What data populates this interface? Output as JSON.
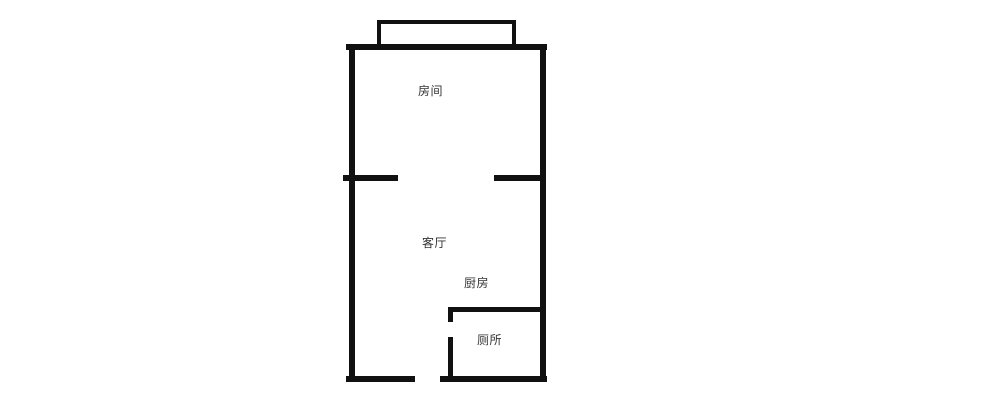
{
  "canvas": {
    "width": 1000,
    "height": 415,
    "background": "#ffffff"
  },
  "floorplan": {
    "wall_color": "#111111",
    "label_color": "#333333",
    "rooms": [
      {
        "id": "bedroom",
        "label": "房间",
        "x": 418,
        "y": 85
      },
      {
        "id": "living-room",
        "label": "客厅",
        "x": 422,
        "y": 237
      },
      {
        "id": "kitchen",
        "label": "厨房",
        "x": 464,
        "y": 277
      },
      {
        "id": "toilet",
        "label": "厕所",
        "x": 477,
        "y": 334
      }
    ],
    "walls": [
      {
        "name": "outer-top",
        "x": 346,
        "y": 44,
        "w": 201,
        "h": 6
      },
      {
        "name": "outer-left",
        "x": 349,
        "y": 44,
        "w": 6,
        "h": 338
      },
      {
        "name": "outer-right",
        "x": 540,
        "y": 44,
        "w": 6,
        "h": 338
      },
      {
        "name": "outer-bottom-left",
        "x": 346,
        "y": 376,
        "w": 69,
        "h": 6
      },
      {
        "name": "outer-bottom-right",
        "x": 440,
        "y": 376,
        "w": 107,
        "h": 6
      },
      {
        "name": "divider-left",
        "x": 343,
        "y": 175,
        "w": 55,
        "h": 6
      },
      {
        "name": "divider-right",
        "x": 494,
        "y": 175,
        "w": 52,
        "h": 6
      },
      {
        "name": "balcony-top",
        "x": 377,
        "y": 20,
        "w": 139,
        "h": 4
      },
      {
        "name": "balcony-left",
        "x": 377,
        "y": 20,
        "w": 4,
        "h": 28
      },
      {
        "name": "balcony-right",
        "x": 512,
        "y": 20,
        "w": 4,
        "h": 28
      },
      {
        "name": "toilet-top",
        "x": 448,
        "y": 307,
        "w": 98,
        "h": 5
      },
      {
        "name": "toilet-wall-upper",
        "x": 448,
        "y": 307,
        "w": 5,
        "h": 15
      },
      {
        "name": "toilet-wall-lower",
        "x": 448,
        "y": 337,
        "w": 5,
        "h": 45
      }
    ]
  }
}
